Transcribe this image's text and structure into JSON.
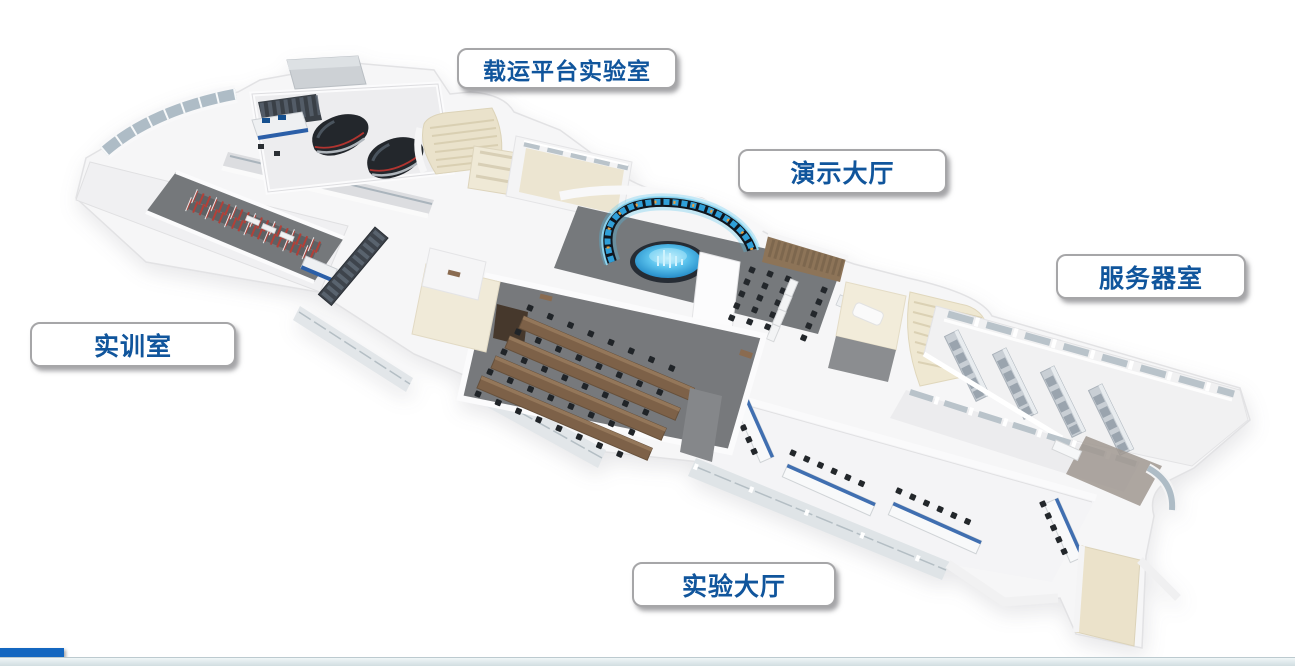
{
  "floorplan": {
    "type": "3d-isometric-floor-plan",
    "rooms": [
      {
        "id": "carrier-platform-lab",
        "label": "载运平台实验室"
      },
      {
        "id": "demo-hall",
        "label": "演示大厅"
      },
      {
        "id": "server-room",
        "label": "服务器室"
      },
      {
        "id": "training-room",
        "label": "实训室"
      },
      {
        "id": "experiment-hall",
        "label": "实验大厅"
      }
    ],
    "label_style": {
      "text_color": "#10559c",
      "background": "#ffffff",
      "border_color": "#a6a6a8"
    },
    "render_palette": {
      "wall_white": "#f4f4f6",
      "dark_floor": "#76797c",
      "light_floor": "#f1f1f2",
      "beige_floor": "#ece4cd",
      "wood_brown": "#7d6148",
      "curtain_brown": "#8d7458",
      "screen_glow_cyan": "#4ec4f0",
      "hologram_blue": "#5cc4ee",
      "track_red": "#b24038",
      "rack_gray": "#c9cfd5",
      "dark_equipment": "#23272c",
      "glass_gray": "#b9c3ca",
      "console_blue": "#2b5fa8"
    }
  },
  "footer": {
    "accent_bar_color": "#1467c0",
    "strip_top_color": "#f0f6f7",
    "strip_bottom_color": "#cddade"
  }
}
